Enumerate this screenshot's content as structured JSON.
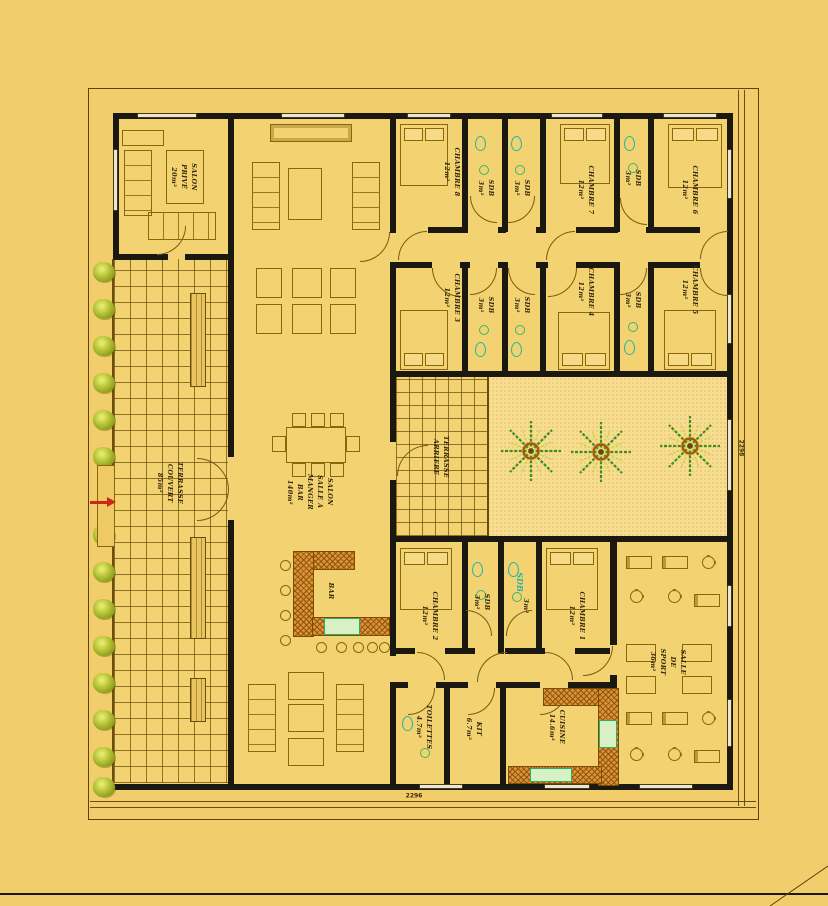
{
  "plan": {
    "labels": {
      "salon_prive": "SALON\nPRIVÉ\n20m²",
      "terrasse_couvert": "TERRASSE\nCOUVERT\n85m²",
      "salon_main": "SALON\nSALLE A\nMANGER\nBAR\n140m²",
      "terrasse_arriere": "TERRASSE\nARRIERE",
      "bar": "BAR",
      "chambre_8": "CHAMBRE 8\n12m²",
      "chambre_7": "CHAMBRE 7\n12m²",
      "chambre_6": "CHAMBRE 6\n12m²",
      "chambre_5": "CHAMBRE 5\n12m²",
      "chambre_4": "CHAMBRE 4\n12m²",
      "chambre_3": "CHAMBRE 3\n12m²",
      "chambre_2": "CHAMBRE 2\n12m²",
      "chambre_1": "CHAMBRE 1\n12m²",
      "sdb": "SDB\n3m²",
      "sdb_large": "SDB",
      "sdb_area": "3m²",
      "salle_sport": "SALLE\nDE\nSPORT\n36m²",
      "toilettes": "TOILETTES\n4.7m²",
      "kit": "KIT\n6.7m²",
      "cuisine": "CUISINE\n14.6m²"
    },
    "dimensions": {
      "bottom": "2296",
      "right": "2298"
    },
    "colors": {
      "background": "#f1cd6b",
      "wall": "#1b190f",
      "line": "#8a660f",
      "courtyard": "#f7dd90",
      "counter_hatch": "#d89434",
      "fixture_teal": "#2ab5a0",
      "fixture_green": "#3cb46e",
      "vegetation": "#aebc2e",
      "palm_green": "#3c8f1e",
      "arrow_red": "#d02615"
    }
  }
}
